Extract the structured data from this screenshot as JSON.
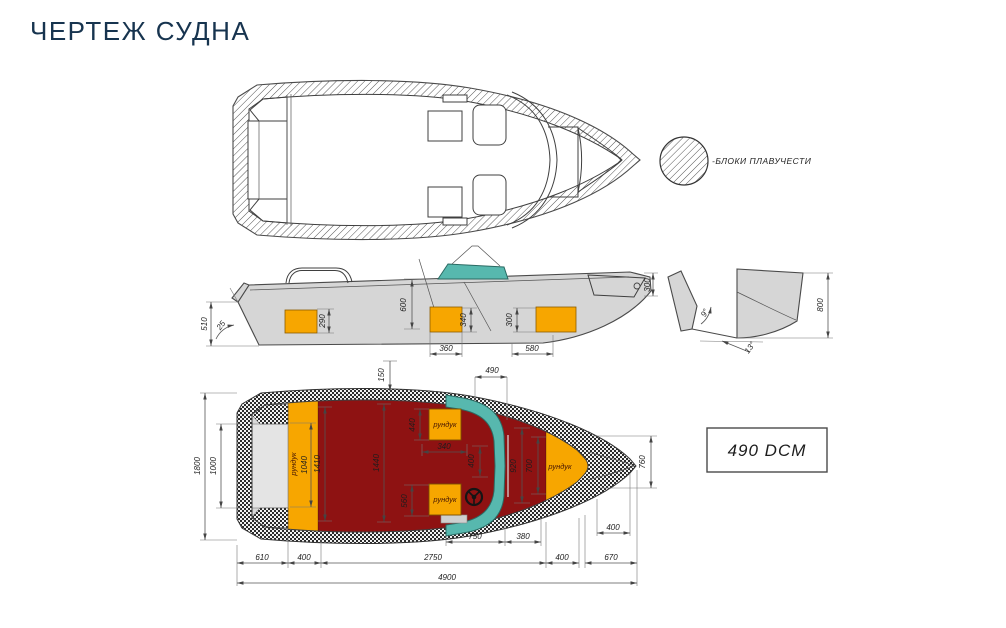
{
  "title": "ЧЕРТЕЖ СУДНА",
  "buoyancy_label": "-БЛОКИ ПЛАВУЧЕСТИ",
  "info_box_label": "490 DCM",
  "locker_label": "рундук",
  "colors": {
    "title_navy": "#17344f",
    "deck_red": "#8e1212",
    "locker_orange": "#f7a600",
    "windshield_teal": "#57b8ae",
    "hull_grey": "#d6d6d6",
    "stern_grey": "#d8d8d8"
  },
  "side": {
    "h510": "510",
    "a25": "25",
    "h290": "290",
    "h600": "600",
    "h340": "340",
    "h300": "300",
    "w360": "360",
    "w580": "580",
    "bow300": "300"
  },
  "section": {
    "h800": "800",
    "a9": "9°",
    "a13": "13°"
  },
  "plan": {
    "d150": "150",
    "d490": "490",
    "d1800": "1800",
    "d1000": "1000",
    "d1040": "1040",
    "d1410": "1410",
    "d1440": "1440",
    "d440": "440",
    "d340": "340",
    "d400gap": "400",
    "d560": "560",
    "d920": "920",
    "d700": "700",
    "d760": "760",
    "d400bow": "400",
    "d750": "750",
    "d380": "380",
    "d610": "610",
    "d400a": "400",
    "d2750": "2750",
    "d400b": "400",
    "d670": "670",
    "d4900": "4900"
  }
}
